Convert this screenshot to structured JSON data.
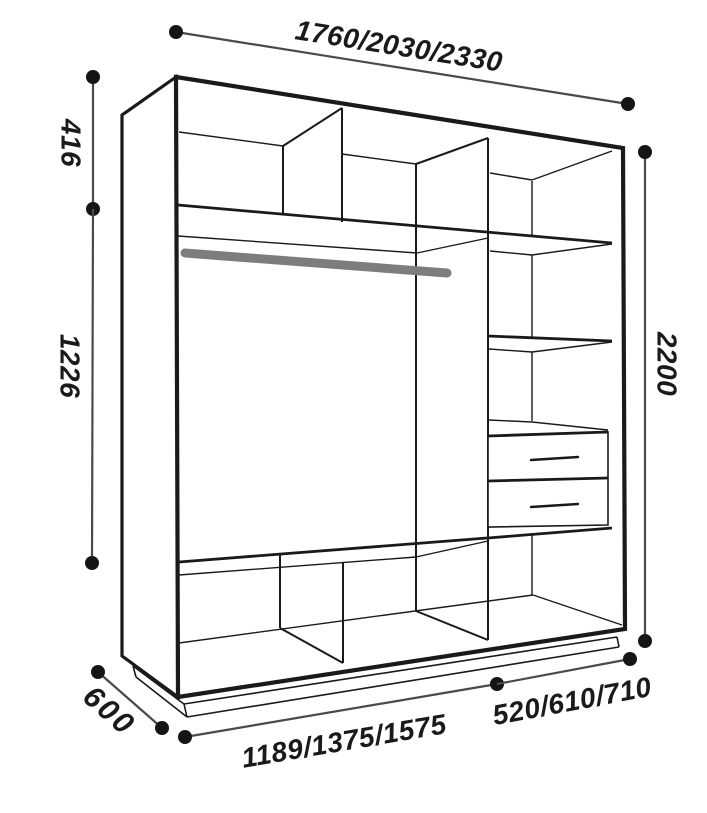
{
  "diagram": {
    "title": "wardrobe-interior-dimension-drawing",
    "dimensions": [
      {
        "id": "overall-width",
        "label": "1760/2030/2330",
        "position": "top"
      },
      {
        "id": "top-section-height",
        "label": "416",
        "position": "left-upper"
      },
      {
        "id": "hanging-space-height",
        "label": "1226",
        "position": "left-lower"
      },
      {
        "id": "overall-height",
        "label": "2200",
        "position": "right"
      },
      {
        "id": "depth",
        "label": "600",
        "position": "bottom-left-diagonal"
      },
      {
        "id": "left-section-width",
        "label": "1189/1375/1575",
        "position": "bottom-center"
      },
      {
        "id": "right-section-width",
        "label": "520/610/710",
        "position": "bottom-right"
      }
    ],
    "colors": {
      "line": "#1a1a1a",
      "dim": "#4a4a4a",
      "dot": "#151515",
      "rod": "#7d7d7d",
      "bg": "#ffffff"
    }
  }
}
